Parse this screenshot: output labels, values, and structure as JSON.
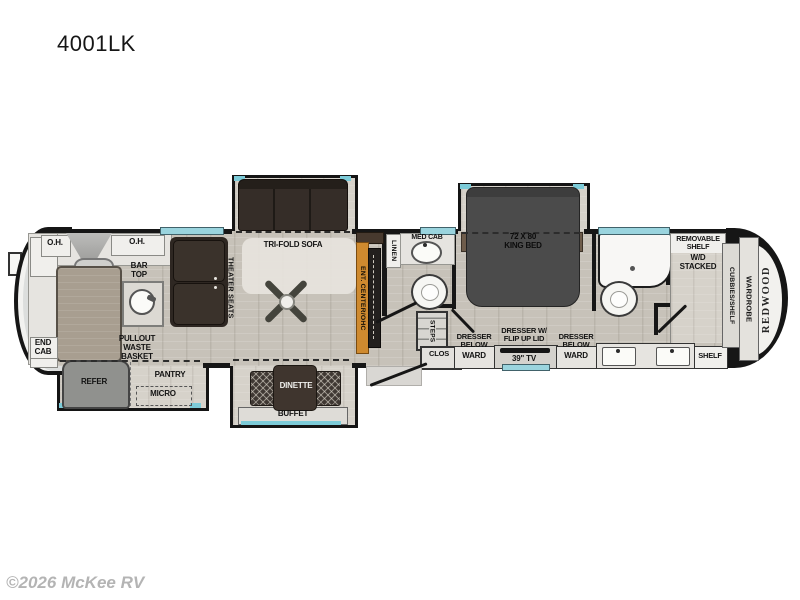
{
  "title": "4001LK",
  "watermark": "©2026 McKee RV",
  "brand": "REDWOOD",
  "colors": {
    "accent_teal": "#7ccbd8",
    "accent_orange": "#cf8a2f",
    "wall": "#161616",
    "furniture_dark": "#352d28",
    "bed_gray": "#4b4b4b"
  },
  "labels": {
    "oh_left": "O.H.",
    "oh_right": "O.H.",
    "bar_top": "BAR\nTOP",
    "theater_seats": "THEATER SEATS",
    "end_cab": "END\nCAB",
    "pullout_waste": "PULLOUT\nWASTE\nBASKET",
    "refer": "REFER",
    "pantry": "PANTRY",
    "micro": "MICRO",
    "tri_fold_sofa": "TRI-FOLD SOFA",
    "ent_center": "ENT. CENTER/OHC",
    "linen": "LINEN",
    "med_cab": "MED CAB",
    "steps": "STEPS",
    "clos": "CLOS",
    "dinette": "DINETTE",
    "buffet": "BUFFET",
    "king_bed": "72 X 80\nKING BED",
    "dresser_below_left": "DRESSER\nBELOW",
    "ward_left": "WARD",
    "dresser_flip": "DRESSER W/\nFLIP UP LID",
    "tv": "39\" TV",
    "dresser_below_right": "DRESSER\nBELOW",
    "ward_right": "WARD",
    "removable_shelf": "REMOVABLE\nSHELF",
    "wd_stacked": "W/D\nSTACKED",
    "cubbies_shelf": "CUBBIES/SHELF",
    "wardrobe": "WARDROBE",
    "shelf": "SHELF"
  }
}
